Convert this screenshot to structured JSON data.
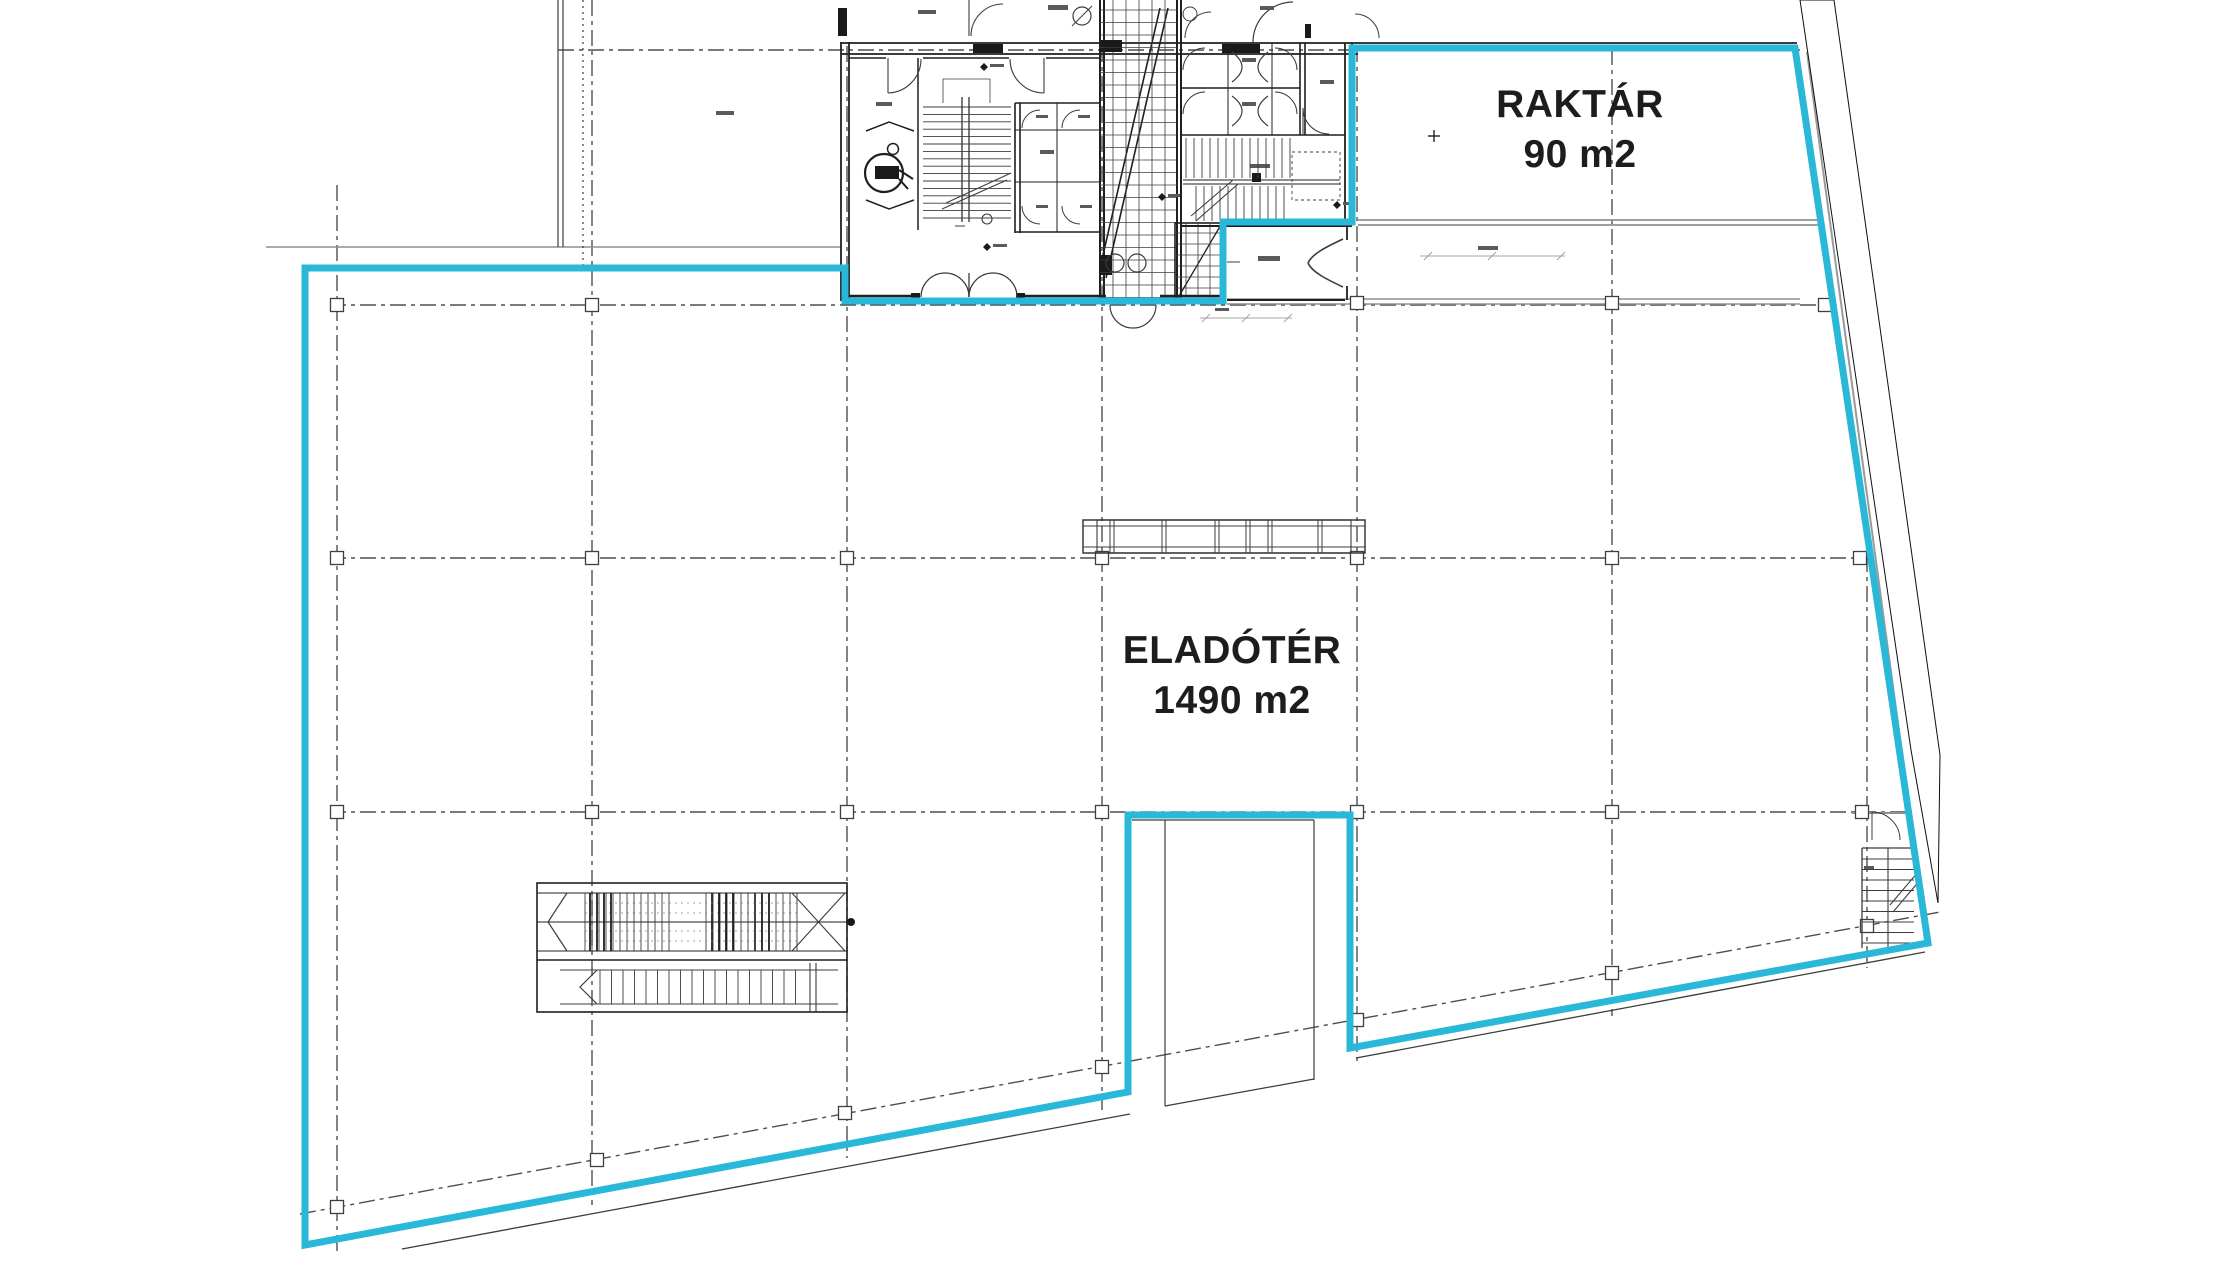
{
  "labels": {
    "raktar": {
      "title": "RAKTÁR",
      "area": "90 m2"
    },
    "eladoter": {
      "title": "ELADÓTÉR",
      "area": "1490 m2"
    }
  },
  "colors": {
    "outline": "#29b8d8",
    "ink": "#1d1d1f",
    "wall": "#1f1f1f",
    "band": "#141414",
    "grid": "#4f4f4f",
    "slab": "#8f8f8f",
    "bg": "#ffffff"
  }
}
